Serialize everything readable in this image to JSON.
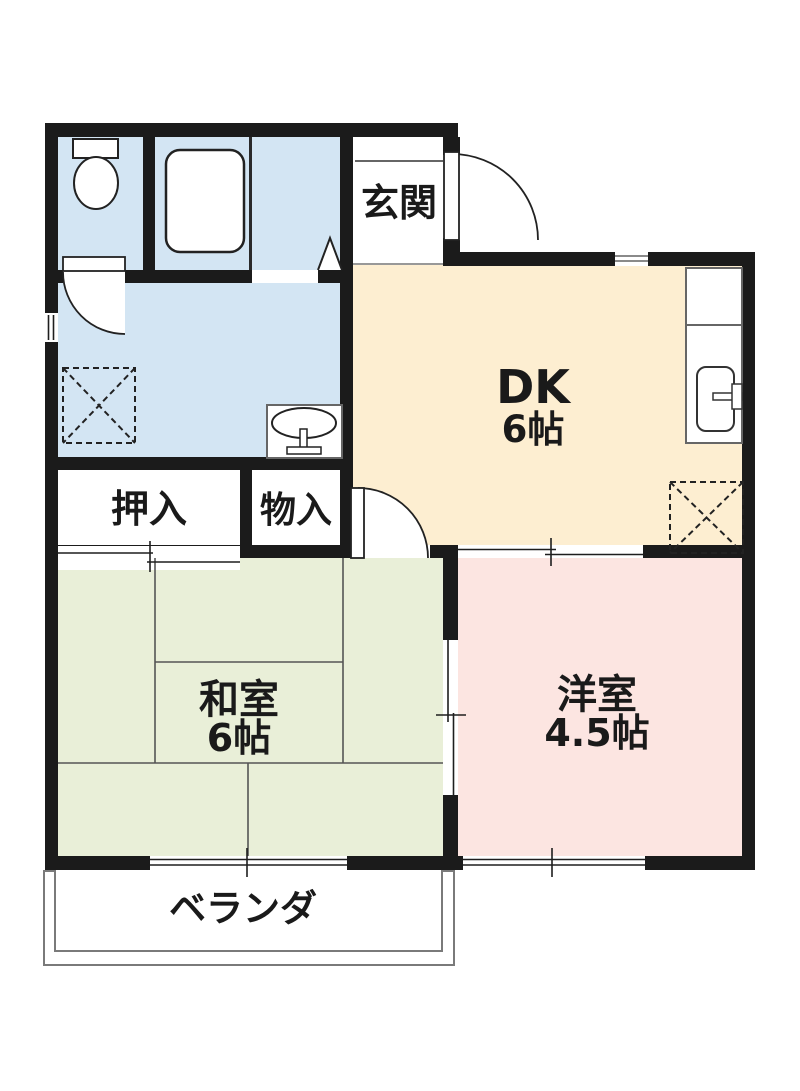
{
  "plan": {
    "title": "apartment-floor-plan",
    "rooms": {
      "genkan": {
        "label": "玄関"
      },
      "dk": {
        "label": "DK",
        "size": "6帖"
      },
      "oshiire": {
        "label": "押入"
      },
      "monoire": {
        "label": "物入"
      },
      "washitsu": {
        "label": "和室",
        "size": "6帖"
      },
      "youshitsu": {
        "label": "洋室",
        "size": "4.5帖"
      },
      "veranda": {
        "label": "ベランダ"
      }
    },
    "fixtures": [
      "toilet-icon",
      "bathtub-icon",
      "folding-door-icon",
      "washing-machine-space-icon",
      "wash-basin-icon",
      "kitchen-sink-icon",
      "refrigerator-space-icon"
    ],
    "colors": {
      "wall": "#1b1b1b",
      "wet-area-blue": "#d3e5f3",
      "dk-peach": "#fdeed1",
      "tatami-green": "#e9efd8",
      "western-pink": "#fce5e1",
      "outline-gray": "#6e6e6e"
    }
  }
}
